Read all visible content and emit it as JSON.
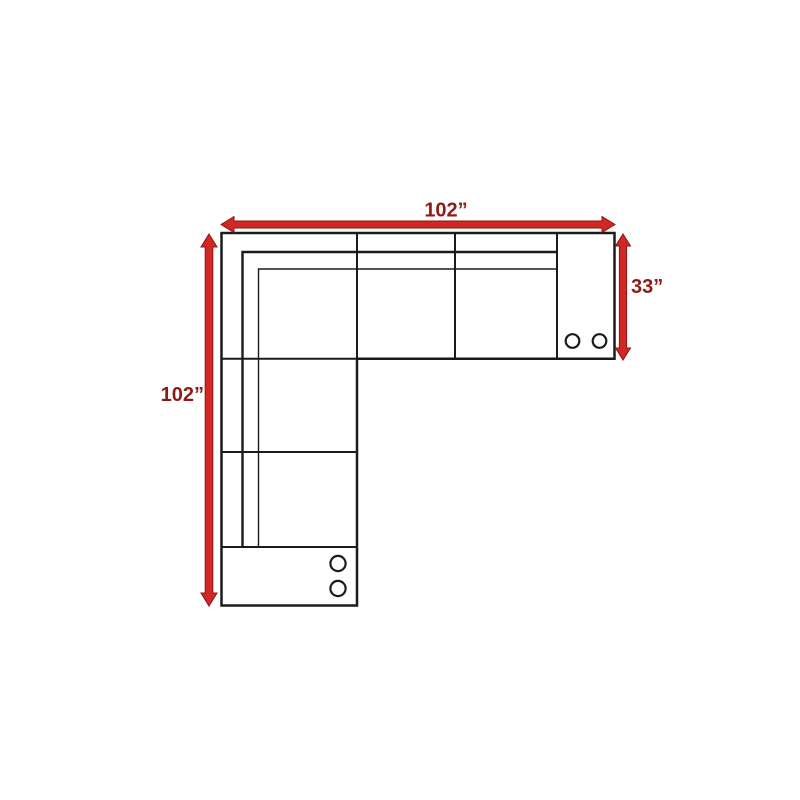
{
  "diagram": {
    "labels": {
      "top_width": "102”",
      "left_height": "102”",
      "right_depth": "33”"
    },
    "colors": {
      "arrow_fill": "#d02824",
      "arrow_edge": "#8e1412",
      "dimension_text": "#8e1c16",
      "outline": "#1b1b1b",
      "surface": "#ffffff",
      "background": "#ffffff"
    }
  }
}
